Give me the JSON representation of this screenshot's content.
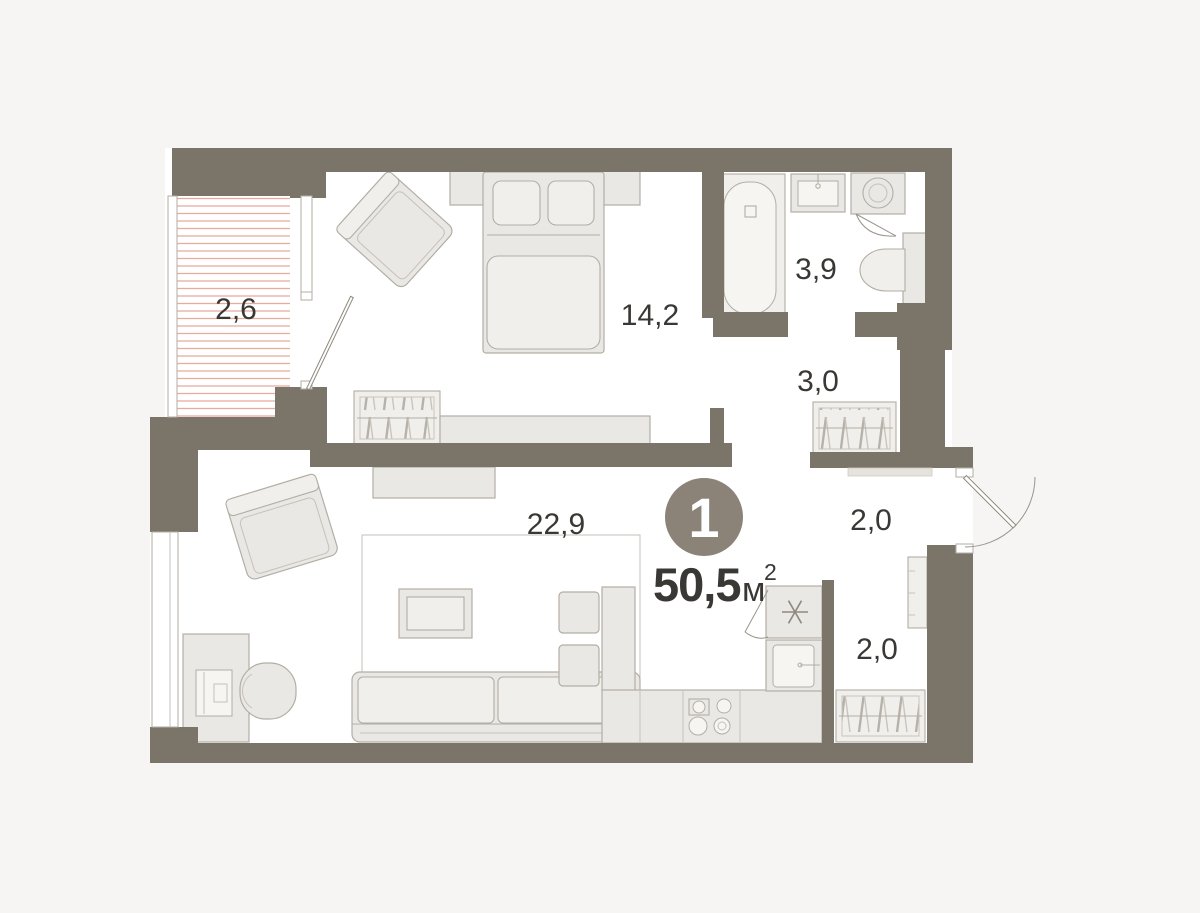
{
  "unit": {
    "number": "1",
    "area_value": "50,5",
    "area_unit": "м",
    "area_superscript": "2"
  },
  "rooms": [
    {
      "id": "balcony",
      "label": "2,6"
    },
    {
      "id": "bedroom",
      "label": "14,2"
    },
    {
      "id": "bathroom",
      "label": "3,9"
    },
    {
      "id": "dressing",
      "label": "3,0"
    },
    {
      "id": "living-kitchen",
      "label": "22,9"
    },
    {
      "id": "hallway-upper",
      "label": "2,0"
    },
    {
      "id": "hallway-lower",
      "label": "2,0"
    }
  ],
  "colors": {
    "wall": "#7b7468",
    "floor": "#ffffff",
    "page_background": "#f6f5f3",
    "furniture_fill": "#eae8e4",
    "furniture_stroke": "#b3aea5",
    "balcony_hatch": "#e7aca0",
    "label_text": "#3a3835",
    "unit_circle": "#8b8278",
    "unit_circle_text": "#ffffff"
  }
}
